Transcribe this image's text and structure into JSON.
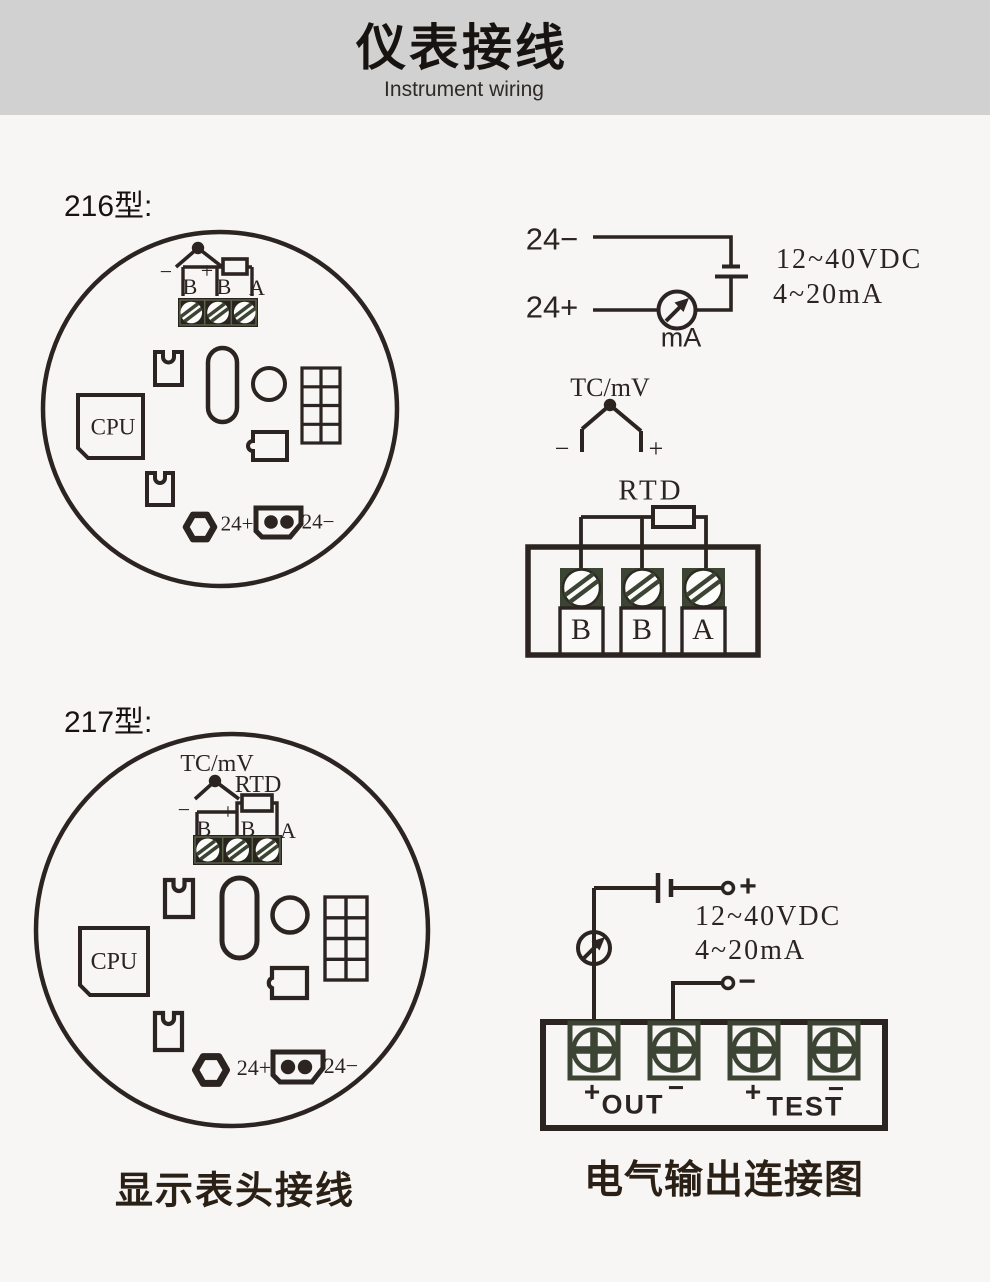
{
  "header": {
    "title": "仪表接线",
    "subtitle": "Instrument wiring"
  },
  "section_216": {
    "label": "216型:"
  },
  "section_217": {
    "label": "217型:"
  },
  "board216": {
    "minus": "−",
    "plus": "+",
    "b1": "B",
    "b2": "B",
    "a": "A",
    "cpu": "CPU",
    "supply_plus": "24+",
    "supply_minus": "24−"
  },
  "loop216": {
    "line_minus": "24−",
    "line_plus": "24+",
    "meter": "mA",
    "spec_voltage": "12~40VDC",
    "spec_current": "4~20mA"
  },
  "sensor216": {
    "tc_label": "TC/mV",
    "tc_minus": "−",
    "tc_plus": "+",
    "rtd_label": "RTD",
    "t1": "B",
    "t2": "B",
    "t3": "A"
  },
  "board217": {
    "tc_label": "TC/mV",
    "rtd_label": "RTD",
    "minus": "−",
    "plus": "+",
    "b1": "B",
    "b2": "B",
    "a": "A",
    "cpu": "CPU",
    "supply_plus": "24+",
    "supply_minus": "24−"
  },
  "output217": {
    "bat_plus": "+",
    "bat_minus": "−",
    "spec_voltage": "12~40VDC",
    "spec_current": "4~20mA",
    "out_plus": "+",
    "out_label": "OUT",
    "out_minus": "−",
    "test_plus": "+",
    "test_label": "TEST",
    "test_minus": "−"
  },
  "captions": {
    "left": "显示表头接线",
    "right": "电气输出连接图"
  },
  "colors": {
    "ink": "#2b2420",
    "olive": "#3c4433",
    "header_bg": "#d2d1d1",
    "page_bg": "#f7f6f5"
  }
}
